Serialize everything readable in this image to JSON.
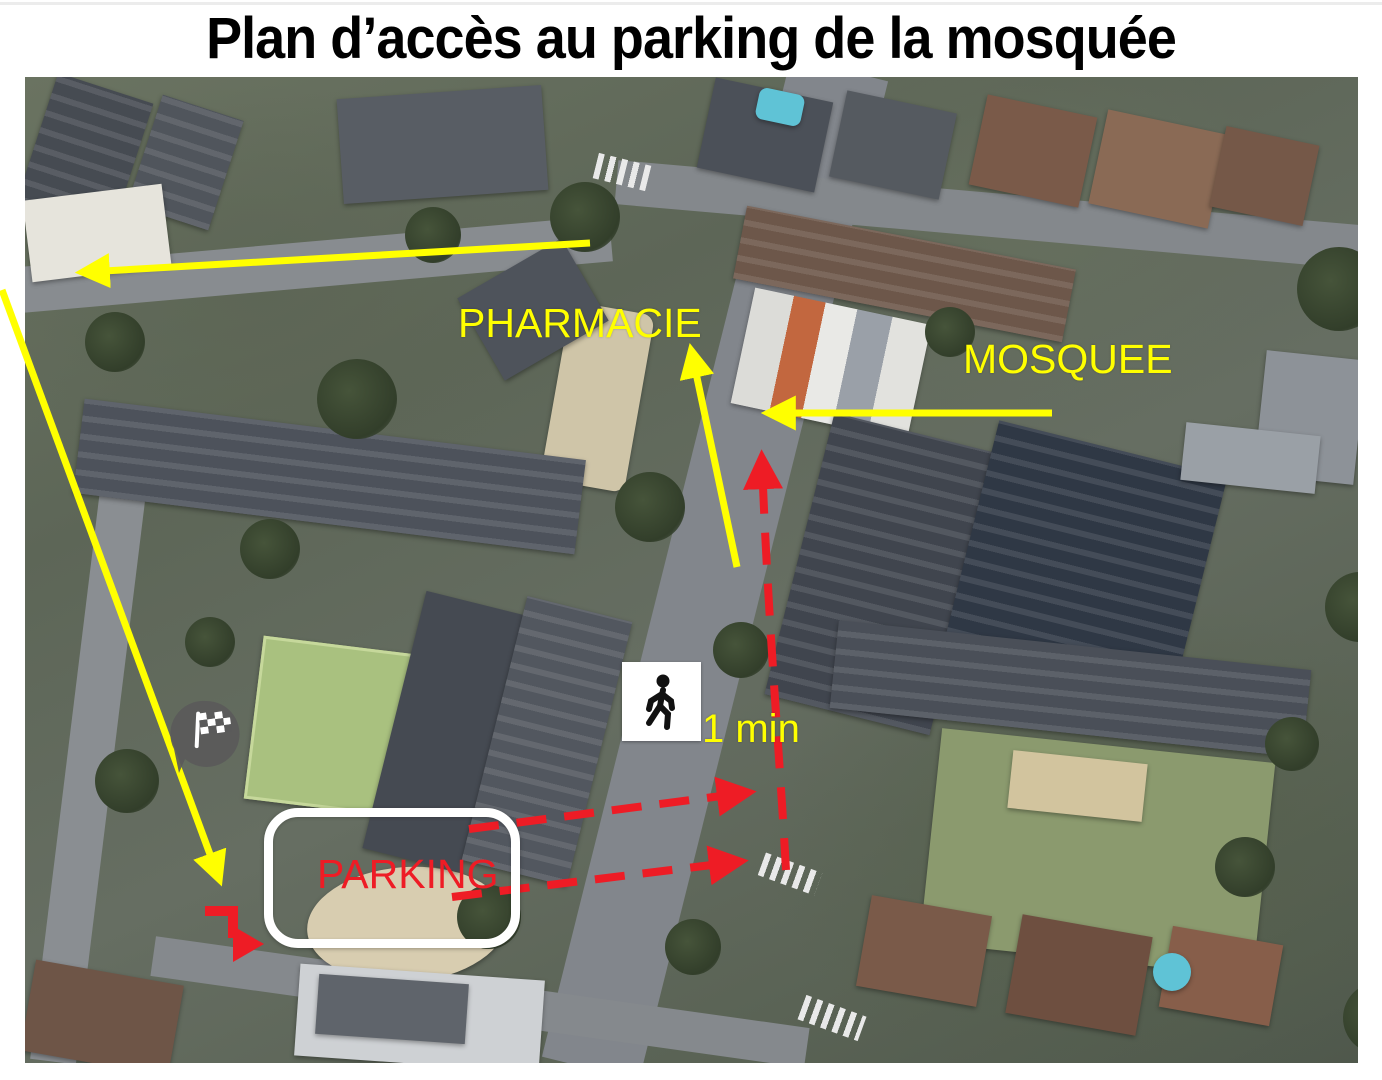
{
  "title": "Plan d’accès au parking de la mosquée",
  "map_labels": {
    "pharmacie": "PHARMACIE",
    "mosquee": "MOSQUEE",
    "parking": "PARKING",
    "walk_time": "1 min"
  },
  "icons": [
    {
      "name": "walking-person-icon",
      "depicts": "pedestrian walking"
    },
    {
      "name": "destination-flag-icon",
      "depicts": "checkered finish flag map pin"
    }
  ],
  "colors": {
    "highlight_yellow": "#ffff00",
    "route_red": "#ee1c25",
    "parking_border_white": "#ffffff",
    "title_black": "#000000"
  },
  "arrows": [
    {
      "color": "yellow",
      "style": "solid",
      "path": "along north street, pointing west"
    },
    {
      "color": "yellow",
      "style": "solid",
      "path": "long diagonal from west edge down to parking entrance, pointing south-east"
    },
    {
      "color": "yellow",
      "style": "solid",
      "path": "along main road, pointing north toward pharmacie"
    },
    {
      "color": "yellow",
      "style": "solid",
      "path": "pointing west toward mosquee entrance"
    },
    {
      "color": "red",
      "style": "dashed",
      "path": "walking route from parking east to main road then north to mosquee"
    },
    {
      "color": "red",
      "style": "solid",
      "path": "small step arrow at parking street entrance, pointing right"
    }
  ]
}
